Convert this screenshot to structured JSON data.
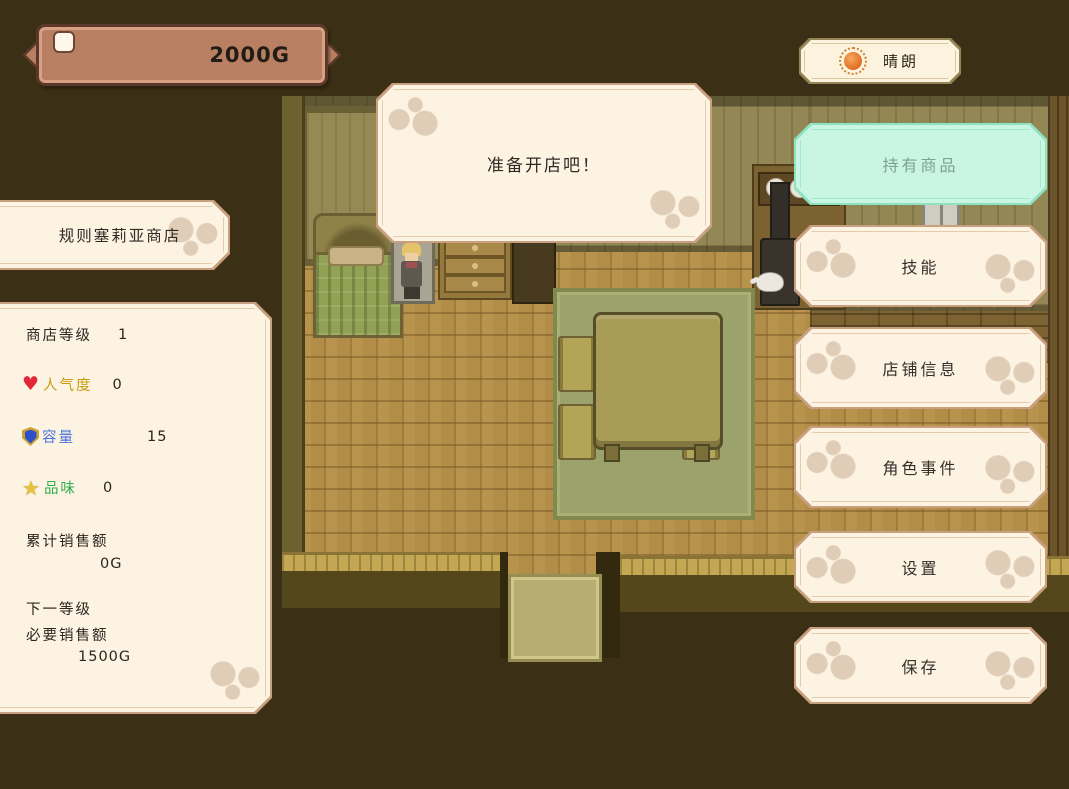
{
  "hud": {
    "money": "2000G",
    "weather": {
      "label": "晴朗",
      "icon": "sun-icon"
    }
  },
  "dialog": {
    "message": "准备开店吧！"
  },
  "shop": {
    "name": "规则塞莉亚商店",
    "stats": {
      "level_label": "商店等级",
      "level_value": "1",
      "popularity_label": "人气度",
      "popularity_value": "0",
      "popularity_icon": "♥",
      "capacity_label": "容量",
      "capacity_value": "15",
      "taste_label": "品味",
      "taste_value": "0",
      "taste_icon": "★",
      "total_sales_label": "累计销售额",
      "total_sales_value": "0G",
      "next_level_label": "下一等级",
      "required_sales_label": "必要销售额",
      "required_sales_value": "1500G"
    }
  },
  "menu": {
    "items": [
      {
        "label": "持有商品",
        "highlighted": true
      },
      {
        "label": "技能",
        "highlighted": false
      },
      {
        "label": "店铺信息",
        "highlighted": false
      },
      {
        "label": "角色事件",
        "highlighted": false
      },
      {
        "label": "设置",
        "highlighted": false
      },
      {
        "label": "保存",
        "highlighted": false
      }
    ]
  },
  "colors": {
    "background": "#3b3015",
    "panel_bg": "#fdf3e3",
    "panel_border": "#c9a07f",
    "highlight_bg": "#c9f6e3",
    "highlight_border": "#8fe3c0",
    "highlight_text": "#7fa093",
    "popularity_color": "#c89c10",
    "capacity_color": "#4a74d8",
    "taste_color": "#2fae4e",
    "sun_color": "#dd6a1e"
  }
}
